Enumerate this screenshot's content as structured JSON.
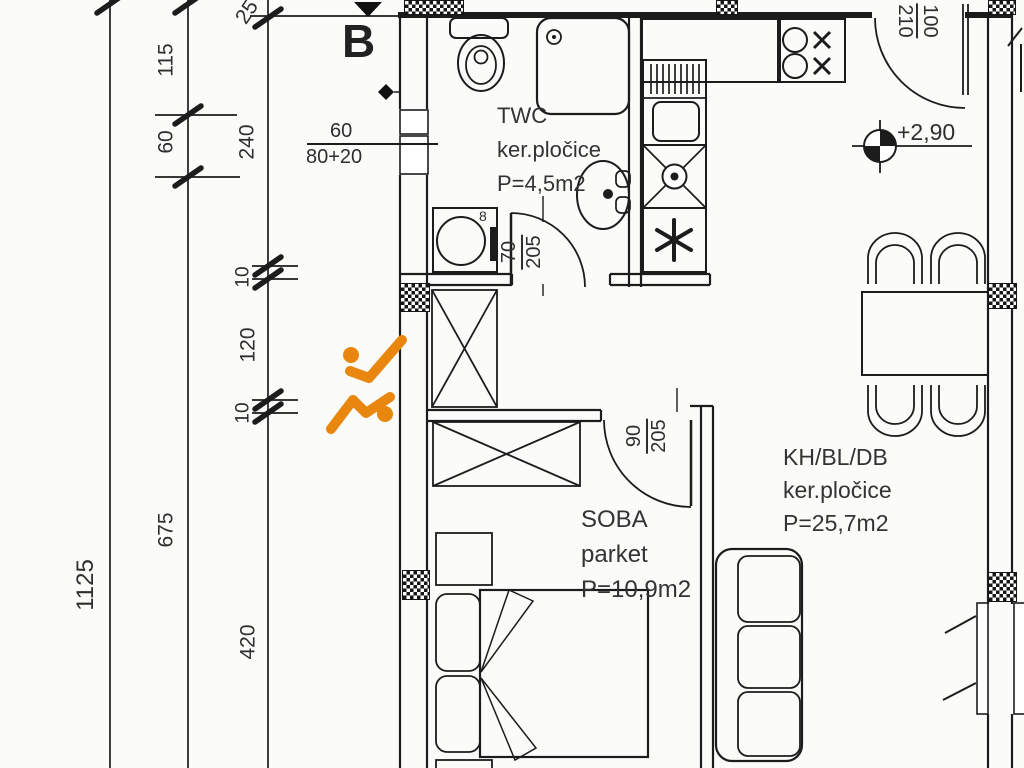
{
  "document": {
    "type": "apartment floor plan"
  },
  "colors": {
    "line": "#1c1c1c",
    "text": "#2e2e2e",
    "accent_orange": "#e8860d",
    "background": "#fbfbfa"
  },
  "section_mark": {
    "label": "B"
  },
  "elevation": {
    "value": "+2,90"
  },
  "window_dim": {
    "width": "60",
    "parapet": "80+20"
  },
  "washer": {
    "label": "8"
  },
  "rooms": {
    "twc": {
      "name": "TWC",
      "floor": "ker.pločice",
      "area": "P=4,5m2"
    },
    "soba": {
      "name": "SOBA",
      "floor": "parket",
      "area": "P=10,9m2"
    },
    "living": {
      "name": "KH/BL/DB",
      "floor": "ker.pločice",
      "area": "P=25,7m2"
    }
  },
  "doors": {
    "bath": {
      "width": "70",
      "height": "205"
    },
    "soba": {
      "width": "90",
      "height": "205"
    },
    "entry": {
      "width": "100",
      "height": "210"
    }
  },
  "dims": {
    "a": [
      "1125"
    ],
    "b": [
      "115",
      "60",
      "675"
    ],
    "c": [
      "25",
      "240",
      "10",
      "120",
      "10",
      "420"
    ]
  }
}
